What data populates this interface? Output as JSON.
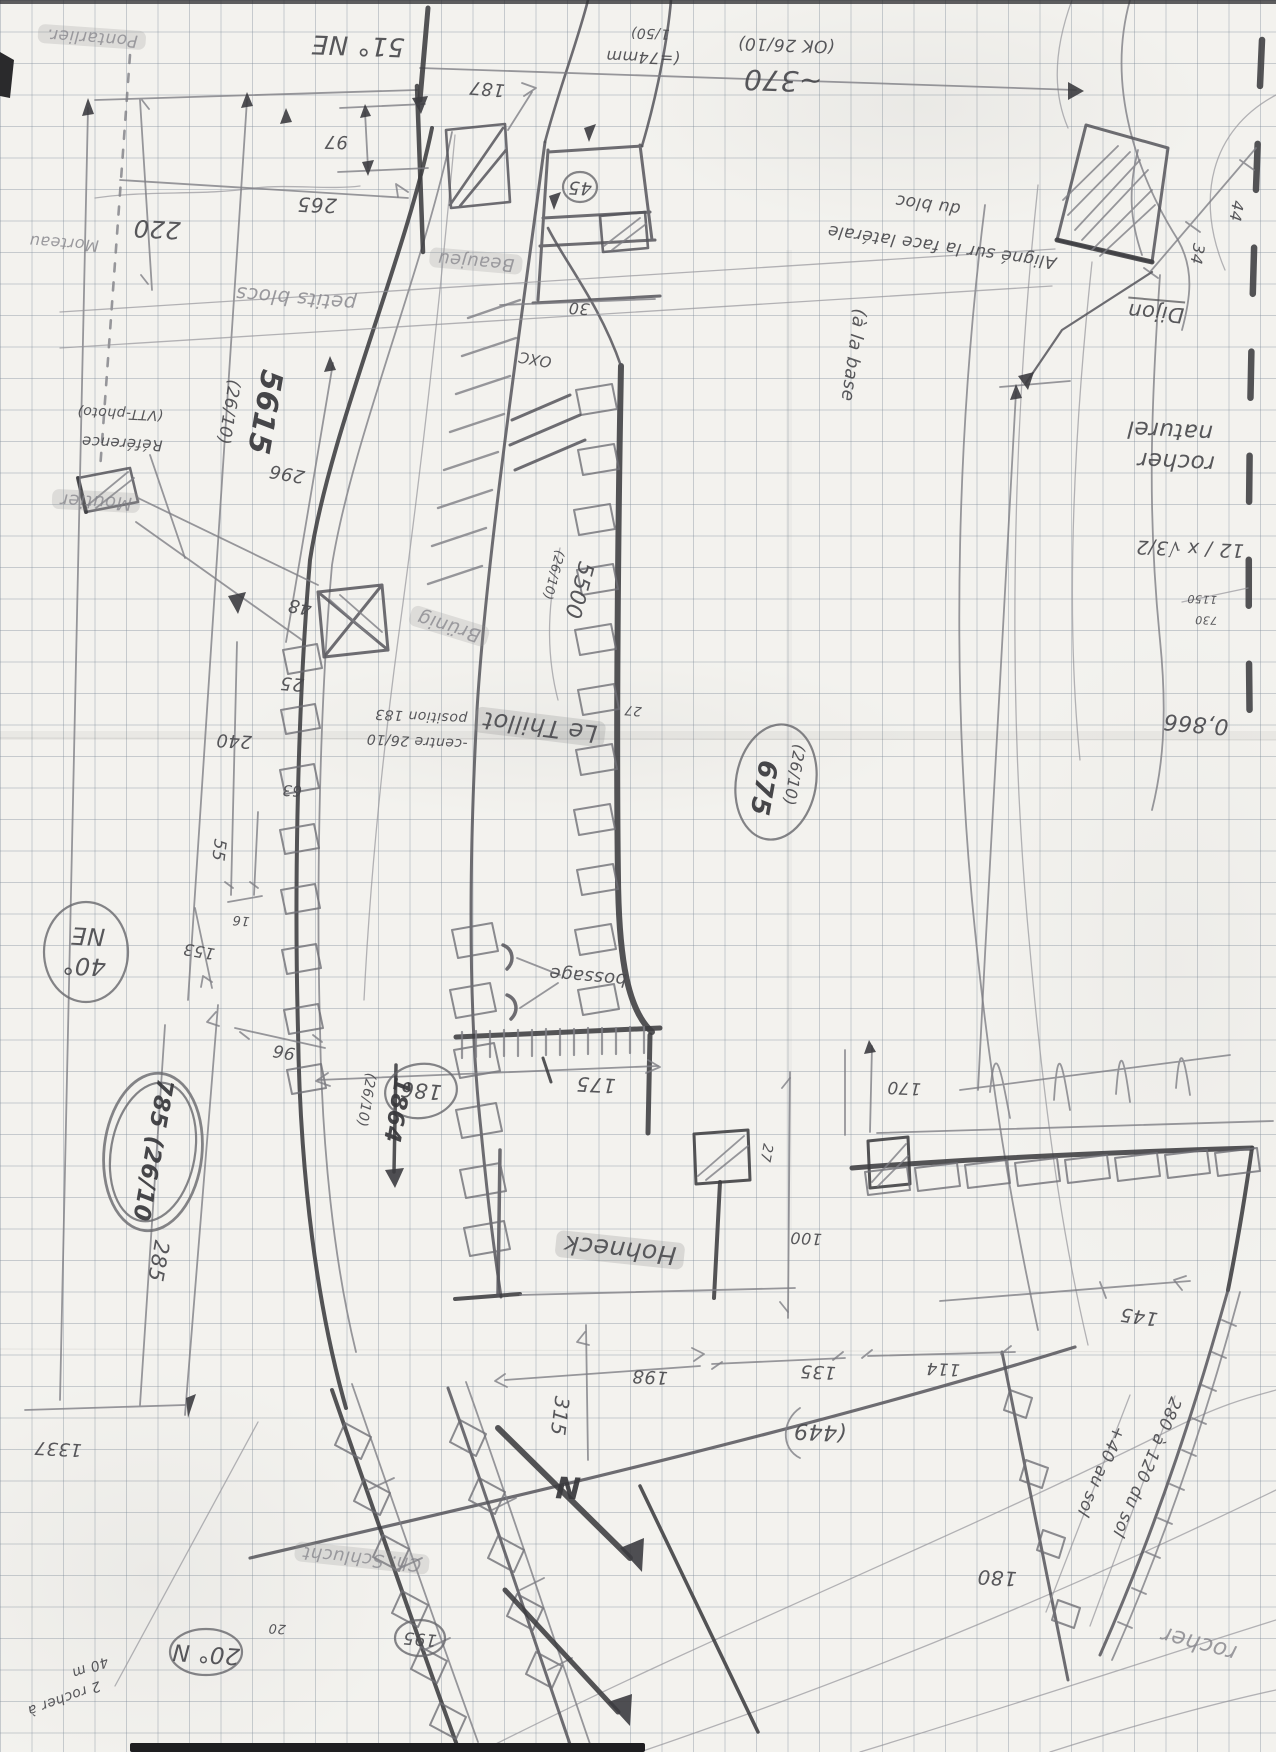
{
  "document": {
    "type": "hand-drawn field survey sketch",
    "medium": "pencil on 5mm squared graph paper",
    "orientation_note": "most annotations are written rotated 180° (page was drawn upside-down)",
    "recurring_date": "26/10"
  },
  "colors": {
    "paper": "#f3f2ee",
    "grid": "#7d8a98",
    "pencil": "#4a4a4e",
    "pencil_dark": "#3c3c40",
    "pencil_light": "#7e7e84",
    "highlight": "rgba(148,148,150,0.30)"
  },
  "compass": {
    "north_label": "N",
    "bearings": [
      "51° NE",
      "40° NE",
      "20° N"
    ]
  },
  "labels": [
    {
      "id": "pontarlier",
      "text": "Pontarlier.",
      "x": 92,
      "y": 37,
      "r": 184,
      "s": 17,
      "c": "faint hl"
    },
    {
      "id": "morteau",
      "text": "Morteau",
      "x": 64,
      "y": 243,
      "r": 184,
      "s": 16,
      "c": "faint"
    },
    {
      "id": "dim-220",
      "text": "220",
      "x": 157,
      "y": 229,
      "r": 183,
      "s": 24,
      "c": ""
    },
    {
      "id": "bearing-51ne",
      "text": "51° NE",
      "x": 358,
      "y": 45,
      "r": 182,
      "s": 26,
      "c": ""
    },
    {
      "id": "dim-187",
      "text": "187",
      "x": 487,
      "y": 88,
      "r": 185,
      "s": 18,
      "c": ""
    },
    {
      "id": "dim-97",
      "text": "97",
      "x": 336,
      "y": 141,
      "r": 181,
      "s": 18,
      "c": ""
    },
    {
      "id": "dim-265",
      "text": "265",
      "x": 317,
      "y": 205,
      "r": 182,
      "s": 20,
      "c": ""
    },
    {
      "id": "scale-74mm",
      "text": "(=74mm",
      "x": 643,
      "y": 57,
      "r": 182,
      "s": 16,
      "c": ""
    },
    {
      "id": "scale-150",
      "text": "1/50)",
      "x": 650,
      "y": 33,
      "r": 182,
      "s": 14,
      "c": ""
    },
    {
      "id": "ok-2610",
      "text": "(OK 26/10)",
      "x": 786,
      "y": 44,
      "r": 182,
      "s": 17,
      "c": ""
    },
    {
      "id": "dim-370",
      "text": "~370",
      "x": 783,
      "y": 80,
      "r": 182,
      "s": 28,
      "c": ""
    },
    {
      "id": "note-aligne",
      "text": "Aligné sur la face latérale",
      "x": 942,
      "y": 246,
      "r": 188,
      "s": 17,
      "c": ""
    },
    {
      "id": "note-du-bloc",
      "text": "du bloc",
      "x": 928,
      "y": 204,
      "r": 188,
      "s": 17,
      "c": ""
    },
    {
      "id": "dijon",
      "text": "Dijon",
      "x": 1156,
      "y": 311,
      "r": 185,
      "s": 21,
      "c": "underline"
    },
    {
      "id": "dim-44",
      "text": "44",
      "x": 1236,
      "y": 211,
      "r": 100,
      "s": 16,
      "c": ""
    },
    {
      "id": "dim-34",
      "text": "34",
      "x": 1197,
      "y": 254,
      "r": 100,
      "s": 16,
      "c": ""
    },
    {
      "id": "petits-blocs",
      "text": "petits blocs",
      "x": 296,
      "y": 299,
      "r": 185,
      "s": 20,
      "c": "faint"
    },
    {
      "id": "beaujeu",
      "text": "Beaujeu",
      "x": 476,
      "y": 261,
      "r": 185,
      "s": 18,
      "c": "faint hl"
    },
    {
      "id": "dim-45",
      "text": "45",
      "x": 580,
      "y": 187,
      "r": 183,
      "s": 18,
      "c": ""
    },
    {
      "id": "dim-30",
      "text": "30",
      "x": 579,
      "y": 308,
      "r": 183,
      "s": 16,
      "c": ""
    },
    {
      "id": "note-oxc",
      "text": "OXC",
      "x": 535,
      "y": 359,
      "r": 190,
      "s": 15,
      "c": ""
    },
    {
      "id": "ref-5615",
      "text": "5615",
      "x": 264,
      "y": 412,
      "r": 100,
      "s": 30,
      "c": "bold"
    },
    {
      "id": "ref-5615-date",
      "text": "(26/10)",
      "x": 228,
      "y": 412,
      "r": 100,
      "s": 17,
      "c": ""
    },
    {
      "id": "note-reference",
      "text": "Référence",
      "x": 122,
      "y": 443,
      "r": 183,
      "s": 15,
      "c": ""
    },
    {
      "id": "note-vtt-photo",
      "text": "(VTT-photo)",
      "x": 120,
      "y": 413,
      "r": 183,
      "s": 14,
      "c": ""
    },
    {
      "id": "dim-296",
      "text": "296",
      "x": 287,
      "y": 473,
      "r": 190,
      "s": 18,
      "c": ""
    },
    {
      "id": "moutier",
      "text": "Moutier",
      "x": 96,
      "y": 501,
      "r": 183,
      "s": 18,
      "c": "faint hl"
    },
    {
      "id": "dim-48",
      "text": "48",
      "x": 300,
      "y": 606,
      "r": 190,
      "s": 18,
      "c": ""
    },
    {
      "id": "dim-25",
      "text": "25",
      "x": 292,
      "y": 683,
      "r": 185,
      "s": 18,
      "c": ""
    },
    {
      "id": "dim-240",
      "text": "240",
      "x": 234,
      "y": 740,
      "r": 183,
      "s": 18,
      "c": ""
    },
    {
      "id": "brunig",
      "text": "Brünig",
      "x": 449,
      "y": 626,
      "r": 197,
      "s": 19,
      "c": "faint hl"
    },
    {
      "id": "note-centre",
      "text": "-centre 26/10",
      "x": 417,
      "y": 741,
      "r": 183,
      "s": 14,
      "c": ""
    },
    {
      "id": "note-position",
      "text": "position 183",
      "x": 421,
      "y": 716,
      "r": 183,
      "s": 14,
      "c": ""
    },
    {
      "id": "le-thillot",
      "text": "Le Thillot",
      "x": 540,
      "y": 727,
      "r": 187,
      "s": 24,
      "c": "hl"
    },
    {
      "id": "ref-5500",
      "text": "5500",
      "x": 578,
      "y": 590,
      "r": 105,
      "s": 22,
      "c": ""
    },
    {
      "id": "ref-5500-date",
      "text": "(26/10)",
      "x": 553,
      "y": 575,
      "r": 105,
      "s": 13,
      "c": ""
    },
    {
      "id": "ref-675",
      "text": "675",
      "x": 763,
      "y": 788,
      "r": 100,
      "s": 26,
      "c": "bold"
    },
    {
      "id": "ref-675-date",
      "text": "(26/10)",
      "x": 794,
      "y": 775,
      "r": 100,
      "s": 16,
      "c": ""
    },
    {
      "id": "dim-27-wall",
      "text": "27",
      "x": 633,
      "y": 710,
      "r": 185,
      "s": 13,
      "c": ""
    },
    {
      "id": "note-a-la-base",
      "text": "(à la base",
      "x": 853,
      "y": 355,
      "r": 98,
      "s": 18,
      "c": ""
    },
    {
      "id": "rocher-naturel-1",
      "text": "rocher",
      "x": 1176,
      "y": 461,
      "r": 183,
      "s": 23,
      "c": ""
    },
    {
      "id": "rocher-naturel-2",
      "text": "naturel",
      "x": 1170,
      "y": 430,
      "r": 183,
      "s": 23,
      "c": ""
    },
    {
      "id": "calc-sqrt",
      "text": "12 / x √3/2",
      "x": 1190,
      "y": 548,
      "r": 182,
      "s": 19,
      "c": ""
    },
    {
      "id": "calc-1150",
      "text": "1150",
      "x": 1202,
      "y": 599,
      "r": 182,
      "s": 11,
      "c": ""
    },
    {
      "id": "calc-730",
      "text": "730",
      "x": 1206,
      "y": 620,
      "r": 182,
      "s": 11,
      "c": ""
    },
    {
      "id": "calc-0866",
      "text": "0,866",
      "x": 1196,
      "y": 723,
      "r": 185,
      "s": 22,
      "c": ""
    },
    {
      "id": "dim-63",
      "text": "63",
      "x": 292,
      "y": 790,
      "r": 183,
      "s": 15,
      "c": ""
    },
    {
      "id": "dim-55",
      "text": "55",
      "x": 218,
      "y": 850,
      "r": 97,
      "s": 17,
      "c": ""
    },
    {
      "id": "dim-16",
      "text": "16",
      "x": 241,
      "y": 920,
      "r": 185,
      "s": 13,
      "c": ""
    },
    {
      "id": "dim-153",
      "text": "153",
      "x": 199,
      "y": 951,
      "r": 190,
      "s": 16,
      "c": ""
    },
    {
      "id": "bearing-ne",
      "text": "NE",
      "x": 88,
      "y": 936,
      "r": 183,
      "s": 24,
      "c": ""
    },
    {
      "id": "bearing-40",
      "text": "40°",
      "x": 84,
      "y": 966,
      "r": 183,
      "s": 24,
      "c": ""
    },
    {
      "id": "dim-96",
      "text": "96",
      "x": 284,
      "y": 1051,
      "r": 190,
      "s": 17,
      "c": ""
    },
    {
      "id": "ref-785",
      "text": "785 (26/10",
      "x": 152,
      "y": 1150,
      "r": 100,
      "s": 23,
      "c": "bold"
    },
    {
      "id": "dim-285",
      "text": "285",
      "x": 158,
      "y": 1261,
      "r": 100,
      "s": 21,
      "c": ""
    },
    {
      "id": "note-bossage",
      "text": "bossage",
      "x": 588,
      "y": 976,
      "r": 185,
      "s": 18,
      "c": ""
    },
    {
      "id": "dim-186",
      "text": "186",
      "x": 421,
      "y": 1090,
      "r": 185,
      "s": 21,
      "c": ""
    },
    {
      "id": "dim-175",
      "text": "175",
      "x": 596,
      "y": 1085,
      "r": 183,
      "s": 20,
      "c": ""
    },
    {
      "id": "ref-1864",
      "text": "1864",
      "x": 396,
      "y": 1110,
      "r": 100,
      "s": 23,
      "c": "bold"
    },
    {
      "id": "ref-1864-date",
      "text": "(26/10)",
      "x": 366,
      "y": 1100,
      "r": 100,
      "s": 14,
      "c": ""
    },
    {
      "id": "hohneck",
      "text": "Hohneck",
      "x": 620,
      "y": 1250,
      "r": 186,
      "s": 25,
      "c": "hl"
    },
    {
      "id": "dim-170",
      "text": "170",
      "x": 904,
      "y": 1087,
      "r": 183,
      "s": 17,
      "c": ""
    },
    {
      "id": "dim-27-gap",
      "text": "27",
      "x": 766,
      "y": 1153,
      "r": 100,
      "s": 14,
      "c": ""
    },
    {
      "id": "dim-100",
      "text": "100",
      "x": 806,
      "y": 1238,
      "r": 183,
      "s": 16,
      "c": ""
    },
    {
      "id": "dim-198",
      "text": "198",
      "x": 650,
      "y": 1376,
      "r": 183,
      "s": 18,
      "c": ""
    },
    {
      "id": "dim-135",
      "text": "135",
      "x": 818,
      "y": 1371,
      "r": 183,
      "s": 18,
      "c": ""
    },
    {
      "id": "dim-114",
      "text": "114",
      "x": 943,
      "y": 1368,
      "r": 183,
      "s": 17,
      "c": ""
    },
    {
      "id": "dim-145",
      "text": "145",
      "x": 1139,
      "y": 1316,
      "r": 188,
      "s": 19,
      "c": ""
    },
    {
      "id": "dim-449",
      "text": "(449",
      "x": 820,
      "y": 1431,
      "r": 183,
      "s": 22,
      "c": ""
    },
    {
      "id": "dim-315",
      "text": "315",
      "x": 560,
      "y": 1416,
      "r": 97,
      "s": 20,
      "c": ""
    },
    {
      "id": "dim-1337",
      "text": "1337",
      "x": 58,
      "y": 1448,
      "r": 183,
      "s": 18,
      "c": ""
    },
    {
      "id": "bearing-20n",
      "text": "20° N",
      "x": 206,
      "y": 1653,
      "r": 184,
      "s": 23,
      "c": ""
    },
    {
      "id": "note-2-rocher",
      "text": "2 rocher à",
      "x": 64,
      "y": 1698,
      "r": 160,
      "s": 14,
      "c": ""
    },
    {
      "id": "note-40m",
      "text": "40 m",
      "x": 90,
      "y": 1667,
      "r": 160,
      "s": 14,
      "c": ""
    },
    {
      "id": "dim-20",
      "text": "20",
      "x": 277,
      "y": 1628,
      "r": 183,
      "s": 13,
      "c": ""
    },
    {
      "id": "dim-195",
      "text": "195",
      "x": 420,
      "y": 1638,
      "r": 185,
      "s": 17,
      "c": ""
    },
    {
      "id": "schlucht",
      "text": "Ch. Schlucht",
      "x": 362,
      "y": 1558,
      "r": 186,
      "s": 18,
      "c": "faint hl"
    },
    {
      "id": "north",
      "text": "N",
      "x": 568,
      "y": 1486,
      "r": 183,
      "s": 30,
      "c": "bold"
    },
    {
      "id": "dim-180",
      "text": "180",
      "x": 997,
      "y": 1578,
      "r": 183,
      "s": 20,
      "c": ""
    },
    {
      "id": "note-280",
      "text": "280 à 120 du sol",
      "x": 1146,
      "y": 1467,
      "r": 113,
      "s": 17,
      "c": ""
    },
    {
      "id": "note-40-sol",
      "text": "+40 au sol",
      "x": 1100,
      "y": 1471,
      "r": 113,
      "s": 17,
      "c": ""
    },
    {
      "id": "rocher-sud",
      "text": "rocher",
      "x": 1199,
      "y": 1643,
      "r": 195,
      "s": 23,
      "c": "faint"
    }
  ]
}
